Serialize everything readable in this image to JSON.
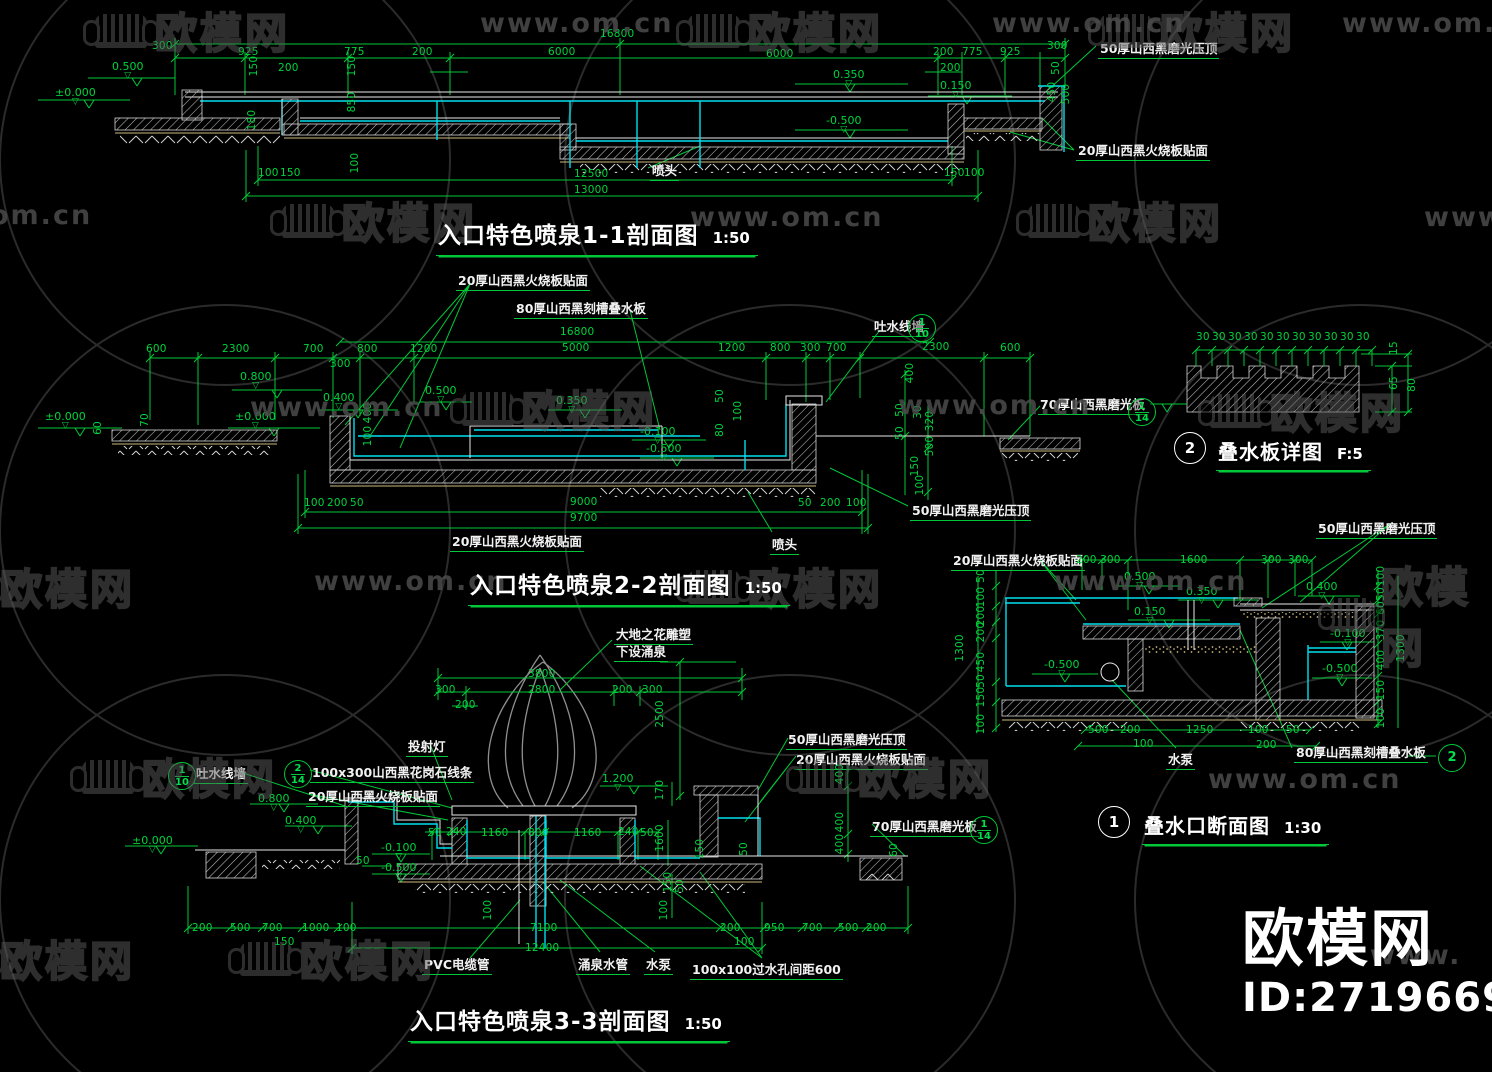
{
  "site": {
    "name": "欧模网",
    "url": "www.om.cn",
    "id_label": "ID:2719669"
  },
  "drawings": [
    {
      "id": "section-1-1",
      "title": "入口特色喷泉1-1剖面图",
      "scale": "1:50"
    },
    {
      "id": "section-2-2",
      "title": "入口特色喷泉2-2剖面图",
      "scale": "1:50"
    },
    {
      "id": "detail-stack-board",
      "bubble": "2",
      "title": "叠水板详图",
      "scale": "F:5"
    },
    {
      "id": "detail-stack-outlet",
      "bubble": "1",
      "title": "叠水口断面图",
      "scale": "1:30"
    },
    {
      "id": "section-3-3",
      "title": "入口特色喷泉3-3剖面图",
      "scale": "1:50"
    }
  ],
  "colors": {
    "dim_green": "#00c838",
    "line_cyan": "#00dff0",
    "line_white": "#e8e8e8",
    "bed_tan": "#cdb87c",
    "background": "#000000",
    "watermark_gray": "#5a5a5a"
  },
  "annotations": [
    {
      "t": "16800",
      "x": 600,
      "y": 28
    },
    {
      "t": "300",
      "x": 152,
      "y": 40
    },
    {
      "t": "925",
      "x": 238,
      "y": 46
    },
    {
      "t": "775",
      "x": 344,
      "y": 46
    },
    {
      "t": "200",
      "x": 412,
      "y": 46
    },
    {
      "t": "6000",
      "x": 548,
      "y": 46
    },
    {
      "t": "6000",
      "x": 766,
      "y": 48
    },
    {
      "t": "200",
      "x": 933,
      "y": 46
    },
    {
      "t": "775",
      "x": 962,
      "y": 46
    },
    {
      "t": "925",
      "x": 1000,
      "y": 46
    },
    {
      "t": "300",
      "x": 1047,
      "y": 40
    },
    {
      "t": "200",
      "x": 278,
      "y": 62
    },
    {
      "t": "200",
      "x": 940,
      "y": 62
    },
    {
      "t": "0.500",
      "x": 112,
      "y": 60,
      "k": "lvl"
    },
    {
      "t": "±0.000",
      "x": 55,
      "y": 86,
      "k": "lvl"
    },
    {
      "t": "0.350",
      "x": 833,
      "y": 68,
      "k": "lvl"
    },
    {
      "t": "0.150",
      "x": 940,
      "y": 79,
      "k": "lvl"
    },
    {
      "t": "-0.500",
      "x": 826,
      "y": 114,
      "k": "lvl"
    },
    {
      "t": "150",
      "x": 254,
      "y": 66,
      "r": 1
    },
    {
      "t": "150",
      "x": 352,
      "y": 66,
      "r": 1
    },
    {
      "t": "850",
      "x": 352,
      "y": 102,
      "r": 1
    },
    {
      "t": "180",
      "x": 252,
      "y": 120,
      "r": 1
    },
    {
      "t": "100",
      "x": 355,
      "y": 163,
      "r": 1
    },
    {
      "t": "50",
      "x": 1056,
      "y": 68,
      "r": 1
    },
    {
      "t": "450",
      "x": 1052,
      "y": 92,
      "r": 1
    },
    {
      "t": "500",
      "x": 1066,
      "y": 94,
      "r": 1
    },
    {
      "t": "50厚山西黑磨光压顶",
      "x": 1098,
      "y": 38,
      "k": "mat"
    },
    {
      "t": "20厚山西黑火烧板贴面",
      "x": 1076,
      "y": 140,
      "k": "mat"
    },
    {
      "t": "喷头",
      "x": 650,
      "y": 160,
      "k": "mat"
    },
    {
      "t": "100",
      "x": 258,
      "y": 167
    },
    {
      "t": "150",
      "x": 280,
      "y": 167
    },
    {
      "t": "12500",
      "x": 574,
      "y": 168
    },
    {
      "t": "13000",
      "x": 574,
      "y": 184
    },
    {
      "t": "150",
      "x": 944,
      "y": 167
    },
    {
      "t": "100",
      "x": 964,
      "y": 167
    },
    {
      "t": "20厚山西黑火烧板贴面",
      "x": 456,
      "y": 270,
      "k": "mat"
    },
    {
      "t": "80厚山西黑刻槽叠水板",
      "x": 514,
      "y": 298,
      "k": "mat"
    },
    {
      "t": "吐水线墙",
      "x": 872,
      "y": 316,
      "k": "mat"
    },
    {
      "t": "16800",
      "x": 560,
      "y": 326
    },
    {
      "t": "5000",
      "x": 562,
      "y": 342
    },
    {
      "t": "600",
      "x": 146,
      "y": 343
    },
    {
      "t": "2300",
      "x": 222,
      "y": 343
    },
    {
      "t": "700",
      "x": 303,
      "y": 343
    },
    {
      "t": "800",
      "x": 357,
      "y": 343
    },
    {
      "t": "1200",
      "x": 410,
      "y": 343
    },
    {
      "t": "1200",
      "x": 718,
      "y": 342
    },
    {
      "t": "800",
      "x": 770,
      "y": 342
    },
    {
      "t": "300",
      "x": 800,
      "y": 342
    },
    {
      "t": "700",
      "x": 826,
      "y": 342
    },
    {
      "t": "2300",
      "x": 922,
      "y": 341
    },
    {
      "t": "600",
      "x": 1000,
      "y": 342
    },
    {
      "t": "300",
      "x": 330,
      "y": 358
    },
    {
      "t": "0.800",
      "x": 240,
      "y": 370,
      "k": "lvl"
    },
    {
      "t": "0.400",
      "x": 323,
      "y": 391,
      "k": "lvl"
    },
    {
      "t": "0.500",
      "x": 425,
      "y": 384,
      "k": "lvl"
    },
    {
      "t": "±0.000",
      "x": 45,
      "y": 410,
      "k": "lvl"
    },
    {
      "t": "±0.000",
      "x": 235,
      "y": 410,
      "k": "lvl"
    },
    {
      "t": "0.350",
      "x": 556,
      "y": 394,
      "k": "lvl"
    },
    {
      "t": "-0.100",
      "x": 640,
      "y": 425,
      "k": "lvl"
    },
    {
      "t": "-0.500",
      "x": 646,
      "y": 442,
      "k": "lvl"
    },
    {
      "t": "60",
      "x": 98,
      "y": 428,
      "r": 1
    },
    {
      "t": "70",
      "x": 145,
      "y": 420,
      "r": 1
    },
    {
      "t": "400",
      "x": 368,
      "y": 413,
      "r": 1
    },
    {
      "t": "100",
      "x": 368,
      "y": 436,
      "r": 1
    },
    {
      "t": "50",
      "x": 720,
      "y": 396,
      "r": 1
    },
    {
      "t": "100",
      "x": 738,
      "y": 411,
      "r": 1
    },
    {
      "t": "80",
      "x": 720,
      "y": 430,
      "r": 1
    },
    {
      "t": "400",
      "x": 910,
      "y": 373,
      "r": 1
    },
    {
      "t": "50",
      "x": 900,
      "y": 410,
      "r": 1
    },
    {
      "t": "30",
      "x": 918,
      "y": 412,
      "r": 1
    },
    {
      "t": "320",
      "x": 930,
      "y": 421,
      "r": 1
    },
    {
      "t": "50",
      "x": 900,
      "y": 433,
      "r": 1
    },
    {
      "t": "500",
      "x": 930,
      "y": 446,
      "r": 1
    },
    {
      "t": "150",
      "x": 915,
      "y": 466,
      "r": 1
    },
    {
      "t": "100",
      "x": 920,
      "y": 485,
      "r": 1
    },
    {
      "t": "70厚山西黑磨光板",
      "x": 1038,
      "y": 394,
      "k": "mat"
    },
    {
      "t": "100",
      "x": 304,
      "y": 497
    },
    {
      "t": "200",
      "x": 327,
      "y": 497
    },
    {
      "t": "50",
      "x": 350,
      "y": 497
    },
    {
      "t": "9000",
      "x": 570,
      "y": 496
    },
    {
      "t": "9700",
      "x": 570,
      "y": 512
    },
    {
      "t": "50",
      "x": 798,
      "y": 497
    },
    {
      "t": "200",
      "x": 820,
      "y": 497
    },
    {
      "t": "100",
      "x": 846,
      "y": 497
    },
    {
      "t": "20厚山西黑火烧板贴面",
      "x": 450,
      "y": 531,
      "k": "mat"
    },
    {
      "t": "喷头",
      "x": 770,
      "y": 534,
      "k": "mat"
    },
    {
      "t": "50厚山西黑磨光压顶",
      "x": 910,
      "y": 500,
      "k": "mat"
    },
    {
      "t": "30",
      "x": 1196,
      "y": 331
    },
    {
      "t": "30",
      "x": 1212,
      "y": 331
    },
    {
      "t": "30",
      "x": 1228,
      "y": 331
    },
    {
      "t": "30",
      "x": 1244,
      "y": 331
    },
    {
      "t": "30",
      "x": 1260,
      "y": 331
    },
    {
      "t": "30",
      "x": 1276,
      "y": 331
    },
    {
      "t": "30",
      "x": 1292,
      "y": 331
    },
    {
      "t": "30",
      "x": 1308,
      "y": 331
    },
    {
      "t": "30",
      "x": 1324,
      "y": 331
    },
    {
      "t": "30",
      "x": 1340,
      "y": 331
    },
    {
      "t": "30",
      "x": 1356,
      "y": 331
    },
    {
      "t": "15",
      "x": 1394,
      "y": 348,
      "r": 1
    },
    {
      "t": "65",
      "x": 1394,
      "y": 383,
      "r": 1
    },
    {
      "t": "80",
      "x": 1412,
      "y": 385,
      "r": 1
    },
    {
      "t": "20厚山西黑火烧板贴面",
      "x": 951,
      "y": 550,
      "k": "mat"
    },
    {
      "t": "50厚山西黑磨光压顶",
      "x": 1316,
      "y": 518,
      "k": "mat"
    },
    {
      "t": "200",
      "x": 1076,
      "y": 554
    },
    {
      "t": "300",
      "x": 1100,
      "y": 554
    },
    {
      "t": "1600",
      "x": 1180,
      "y": 554
    },
    {
      "t": "300",
      "x": 1261,
      "y": 554
    },
    {
      "t": "300",
      "x": 1288,
      "y": 554
    },
    {
      "t": "0.500",
      "x": 1124,
      "y": 570,
      "k": "lvl"
    },
    {
      "t": "0.350",
      "x": 1186,
      "y": 585,
      "k": "lvl"
    },
    {
      "t": "0.150",
      "x": 1134,
      "y": 605,
      "k": "lvl"
    },
    {
      "t": "0.400",
      "x": 1306,
      "y": 580,
      "k": "lvl"
    },
    {
      "t": "-0.100",
      "x": 1330,
      "y": 627,
      "k": "lvl"
    },
    {
      "t": "-0.500",
      "x": 1044,
      "y": 658,
      "k": "lvl"
    },
    {
      "t": "-0.500",
      "x": 1322,
      "y": 662,
      "k": "lvl"
    },
    {
      "t": "50",
      "x": 981,
      "y": 576,
      "r": 1
    },
    {
      "t": "100",
      "x": 981,
      "y": 597,
      "r": 1
    },
    {
      "t": "200",
      "x": 981,
      "y": 616,
      "r": 1
    },
    {
      "t": "200",
      "x": 981,
      "y": 632,
      "r": 1
    },
    {
      "t": "450",
      "x": 981,
      "y": 662,
      "r": 1
    },
    {
      "t": "50",
      "x": 981,
      "y": 681,
      "r": 1
    },
    {
      "t": "150",
      "x": 981,
      "y": 697,
      "r": 1
    },
    {
      "t": "100",
      "x": 981,
      "y": 724,
      "r": 1
    },
    {
      "t": "1300",
      "x": 960,
      "y": 648,
      "r": 1
    },
    {
      "t": "100",
      "x": 1381,
      "y": 576,
      "r": 1
    },
    {
      "t": "50",
      "x": 1381,
      "y": 594,
      "r": 1
    },
    {
      "t": "60",
      "x": 1381,
      "y": 608,
      "r": 1
    },
    {
      "t": "370",
      "x": 1381,
      "y": 630,
      "r": 1
    },
    {
      "t": "400",
      "x": 1381,
      "y": 660,
      "r": 1
    },
    {
      "t": "150",
      "x": 1381,
      "y": 690,
      "r": 1
    },
    {
      "t": "100",
      "x": 1381,
      "y": 718,
      "r": 1
    },
    {
      "t": "1300",
      "x": 1401,
      "y": 648,
      "r": 1
    },
    {
      "t": "500",
      "x": 1088,
      "y": 724
    },
    {
      "t": "200",
      "x": 1120,
      "y": 724
    },
    {
      "t": "100",
      "x": 1133,
      "y": 738
    },
    {
      "t": "1250",
      "x": 1186,
      "y": 724
    },
    {
      "t": "100",
      "x": 1248,
      "y": 724
    },
    {
      "t": "200",
      "x": 1256,
      "y": 739
    },
    {
      "t": "50",
      "x": 1286,
      "y": 724
    },
    {
      "t": "水泵",
      "x": 1166,
      "y": 749,
      "k": "mat"
    },
    {
      "t": "80厚山西黑刻槽叠水板",
      "x": 1294,
      "y": 742,
      "k": "mat"
    },
    {
      "t": "大地之花雕塑",
      "x": 614,
      "y": 624,
      "k": "mat"
    },
    {
      "t": "下设涌泉",
      "x": 614,
      "y": 641,
      "k": "mat"
    },
    {
      "t": "3800",
      "x": 528,
      "y": 668
    },
    {
      "t": "300",
      "x": 435,
      "y": 684
    },
    {
      "t": "2800",
      "x": 528,
      "y": 684
    },
    {
      "t": "200",
      "x": 612,
      "y": 684
    },
    {
      "t": "300",
      "x": 642,
      "y": 684
    },
    {
      "t": "200",
      "x": 455,
      "y": 699
    },
    {
      "t": "2500",
      "x": 660,
      "y": 714,
      "r": 1
    },
    {
      "t": "投射灯",
      "x": 406,
      "y": 736,
      "k": "mat"
    },
    {
      "t": "吐水线墙",
      "x": 194,
      "y": 763,
      "k": "mat"
    },
    {
      "t": "100x300山西黑花岗石线条",
      "x": 310,
      "y": 762,
      "k": "mat"
    },
    {
      "t": "20厚山西黑火烧板贴面",
      "x": 306,
      "y": 786,
      "k": "mat"
    },
    {
      "t": "1.200",
      "x": 602,
      "y": 772,
      "k": "lvl"
    },
    {
      "t": "170",
      "x": 660,
      "y": 790,
      "r": 1
    },
    {
      "t": "0.800",
      "x": 258,
      "y": 792,
      "k": "lvl"
    },
    {
      "t": "0.400",
      "x": 285,
      "y": 814,
      "k": "lvl"
    },
    {
      "t": "±0.000",
      "x": 132,
      "y": 834,
      "k": "lvl"
    },
    {
      "t": "-0.100",
      "x": 381,
      "y": 841,
      "k": "lvl"
    },
    {
      "t": "-0.500",
      "x": 381,
      "y": 861,
      "k": "lvl"
    },
    {
      "t": "50",
      "x": 356,
      "y": 855
    },
    {
      "t": "50",
      "x": 428,
      "y": 827
    },
    {
      "t": "240",
      "x": 446,
      "y": 826
    },
    {
      "t": "1160",
      "x": 481,
      "y": 827
    },
    {
      "t": "800",
      "x": 528,
      "y": 827
    },
    {
      "t": "1160",
      "x": 574,
      "y": 827
    },
    {
      "t": "240",
      "x": 618,
      "y": 826
    },
    {
      "t": "50",
      "x": 640,
      "y": 827
    },
    {
      "t": "1600",
      "x": 660,
      "y": 838,
      "r": 1
    },
    {
      "t": "150",
      "x": 700,
      "y": 849,
      "r": 1
    },
    {
      "t": "50",
      "x": 744,
      "y": 849,
      "r": 1
    },
    {
      "t": "150",
      "x": 668,
      "y": 882,
      "r": 1
    },
    {
      "t": "50",
      "x": 680,
      "y": 886,
      "r": 1
    },
    {
      "t": "100",
      "x": 664,
      "y": 910,
      "r": 1
    },
    {
      "t": "50厚山西黑磨光压顶",
      "x": 786,
      "y": 729,
      "k": "mat"
    },
    {
      "t": "20厚山西黑火烧板贴面",
      "x": 794,
      "y": 749,
      "k": "mat"
    },
    {
      "t": "70厚山西黑磨光板",
      "x": 870,
      "y": 816,
      "k": "mat"
    },
    {
      "t": "400",
      "x": 840,
      "y": 774,
      "r": 1
    },
    {
      "t": "400",
      "x": 840,
      "y": 822,
      "r": 1
    },
    {
      "t": "400",
      "x": 840,
      "y": 844,
      "r": 1
    },
    {
      "t": "60",
      "x": 894,
      "y": 850,
      "r": 1
    },
    {
      "t": "200",
      "x": 192,
      "y": 922
    },
    {
      "t": "500",
      "x": 230,
      "y": 922
    },
    {
      "t": "700",
      "x": 262,
      "y": 922
    },
    {
      "t": "1000",
      "x": 302,
      "y": 922
    },
    {
      "t": "100",
      "x": 336,
      "y": 922
    },
    {
      "t": "150",
      "x": 274,
      "y": 936
    },
    {
      "t": "100",
      "x": 488,
      "y": 910,
      "r": 1
    },
    {
      "t": "7100",
      "x": 530,
      "y": 922
    },
    {
      "t": "12400",
      "x": 525,
      "y": 942
    },
    {
      "t": "200",
      "x": 720,
      "y": 922
    },
    {
      "t": "950",
      "x": 764,
      "y": 922
    },
    {
      "t": "700",
      "x": 802,
      "y": 922
    },
    {
      "t": "500",
      "x": 838,
      "y": 922
    },
    {
      "t": "200",
      "x": 866,
      "y": 922
    },
    {
      "t": "100",
      "x": 734,
      "y": 936
    },
    {
      "t": "PVC电缆管",
      "x": 422,
      "y": 954,
      "k": "mat"
    },
    {
      "t": "涌泉水管",
      "x": 576,
      "y": 954,
      "k": "mat"
    },
    {
      "t": "水泵",
      "x": 644,
      "y": 954,
      "k": "mat"
    },
    {
      "t": "100x100过水孔间距600",
      "x": 690,
      "y": 959,
      "k": "mat"
    }
  ],
  "callouts": [
    {
      "n": "1",
      "d": "10",
      "x": 908,
      "y": 314,
      "variant": "green"
    },
    {
      "n": "1",
      "d": "14",
      "x": 1128,
      "y": 398,
      "variant": "green"
    },
    {
      "n": "1",
      "d": "10",
      "x": 168,
      "y": 762,
      "variant": "green"
    },
    {
      "n": "2",
      "d": "14",
      "x": 284,
      "y": 760,
      "variant": "green"
    },
    {
      "n": "1",
      "d": "14",
      "x": 970,
      "y": 816,
      "variant": "green"
    },
    {
      "n": "2",
      "d": "",
      "x": 1438,
      "y": 744,
      "variant": "green"
    },
    {
      "n": "2",
      "d": "",
      "x": 1174,
      "y": 432,
      "variant": "white"
    },
    {
      "n": "1",
      "d": "",
      "x": 1098,
      "y": 806,
      "variant": "white"
    }
  ],
  "watermarks": {
    "logos": [
      {
        "x": 95,
        "y": 0
      },
      {
        "x": 688,
        "y": 0
      },
      {
        "x": 1100,
        "y": 0
      },
      {
        "x": 282,
        "y": 190
      },
      {
        "x": 1028,
        "y": 190
      },
      {
        "x": 462,
        "y": 378
      },
      {
        "x": 1210,
        "y": 380
      },
      {
        "x": 688,
        "y": 556
      },
      {
        "x": 1330,
        "y": 554
      },
      {
        "x": 82,
        "y": 746
      },
      {
        "x": 798,
        "y": 746
      },
      {
        "x": 240,
        "y": 928
      },
      {
        "x": -60,
        "y": 556
      },
      {
        "x": -60,
        "y": 928
      }
    ],
    "urls": [
      {
        "x": 480,
        "y": 8
      },
      {
        "x": 992,
        "y": 8
      },
      {
        "x": 1342,
        "y": 8
      },
      {
        "x": -10,
        "y": 200,
        "t": "om.cn"
      },
      {
        "x": 690,
        "y": 202
      },
      {
        "x": 1424,
        "y": 202,
        "t": "www."
      },
      {
        "x": 250,
        "y": 392
      },
      {
        "x": 898,
        "y": 390
      },
      {
        "x": 314,
        "y": 566
      },
      {
        "x": 1054,
        "y": 566
      },
      {
        "x": 1208,
        "y": 764
      },
      {
        "x": 1370,
        "y": 940,
        "t": "www."
      }
    ]
  }
}
